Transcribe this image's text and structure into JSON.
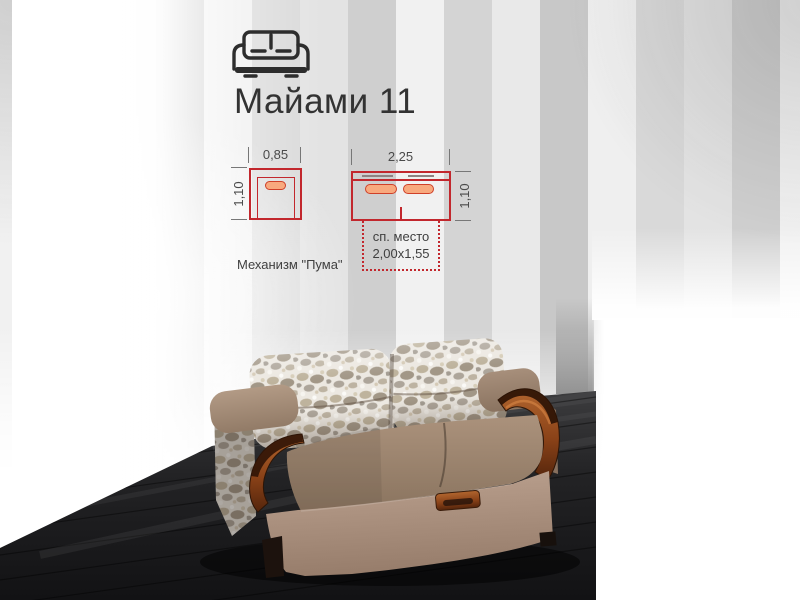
{
  "theme": {
    "accent_red": "#c2272d",
    "cushion_fill": "#f8a97e",
    "title_color": "#333333",
    "wall_gray": "#cdcdcd",
    "floor_color": "#1b1b1d",
    "sofa_fabric": "#a38b77",
    "sofa_wood": "#8f4a20",
    "pillow_fabric": "#ece8e1"
  },
  "header": {
    "icon": "sofa-icon",
    "title": "Майами 11"
  },
  "diagrams": {
    "single_seat": {
      "width_label": "0,85",
      "depth_label": "1,10"
    },
    "sofa_top_view": {
      "width_label": "2,25",
      "depth_label": "1,10"
    },
    "sleeping_place": {
      "caption": "сп. место",
      "dimensions": "2,00x1,55"
    },
    "mechanism": "Механизм \"Пума\""
  },
  "photo": {
    "subject": "sofa-photo",
    "colors": {
      "fabric": "#a38b77",
      "wood": "#8f4a20",
      "pillows": "#ece8e1",
      "floor": "#1b1b1d"
    }
  }
}
